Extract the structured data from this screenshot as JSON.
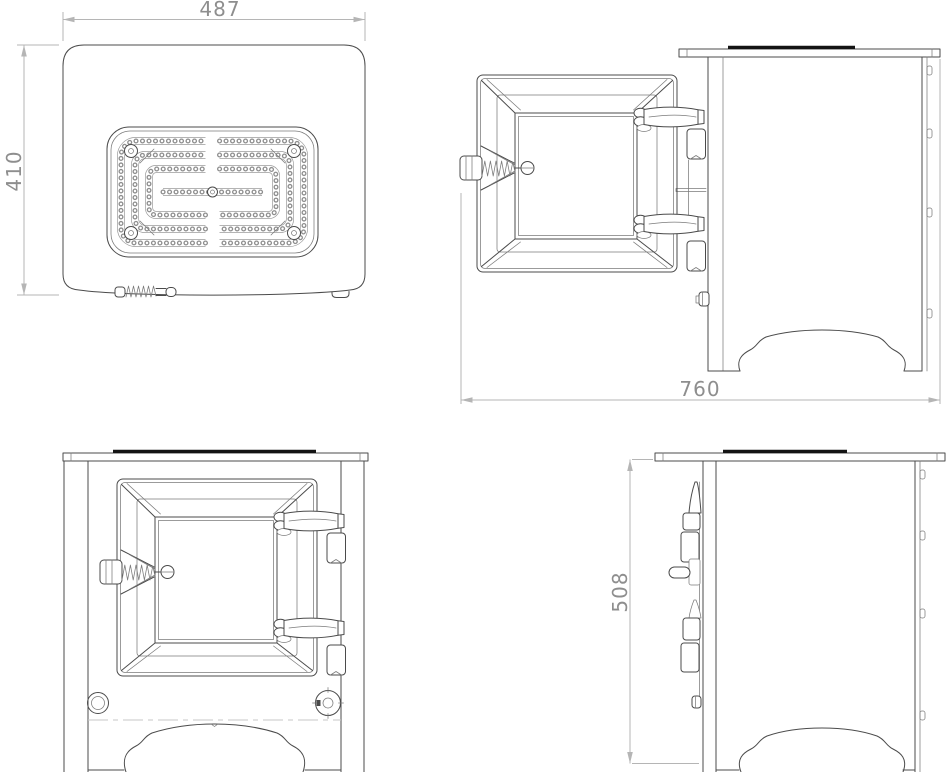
{
  "colors": {
    "line": "#4b4b4b",
    "thin": "#7b7b7b",
    "black": "#141414",
    "dim": "#b5b5b5",
    "dim_text": "#8e8e8e",
    "background": "#ffffff"
  },
  "dimensions": {
    "top_width": "487",
    "top_depth": "410",
    "open_depth": "760",
    "height": "508"
  }
}
